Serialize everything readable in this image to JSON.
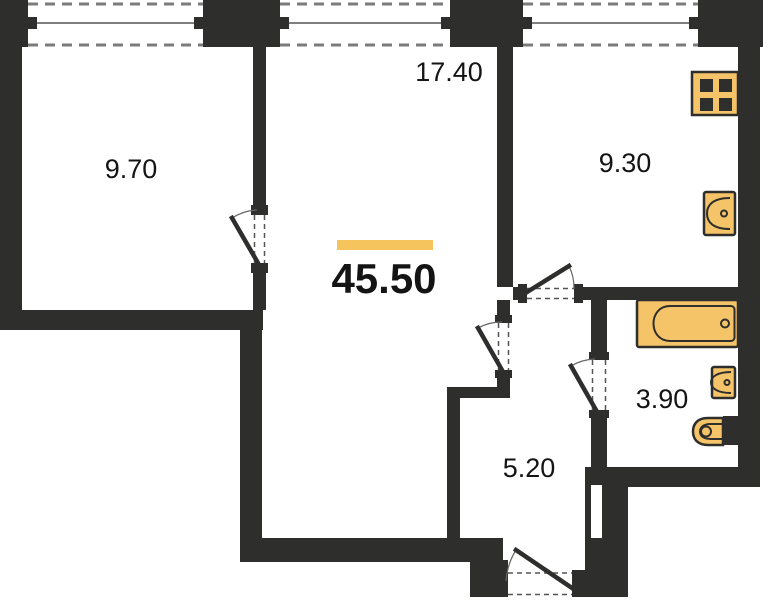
{
  "plan": {
    "title": "apartment-floor-plan",
    "total_area": "45.50",
    "rooms": {
      "bedroom": {
        "area": "9.70"
      },
      "living": {
        "area": "17.40"
      },
      "kitchen": {
        "area": "9.30"
      },
      "bathroom": {
        "area": "3.90"
      },
      "hallway": {
        "area": "5.20"
      }
    },
    "fixtures": [
      "stove-icon",
      "kitchen-sink-icon",
      "bathtub-icon",
      "washbasin-icon",
      "toilet-icon"
    ],
    "colors": {
      "wall": "#2e2e2c",
      "fixture_fill": "#f5c469",
      "accent_bar": "#f6c45c",
      "background": "#ffffff"
    }
  }
}
